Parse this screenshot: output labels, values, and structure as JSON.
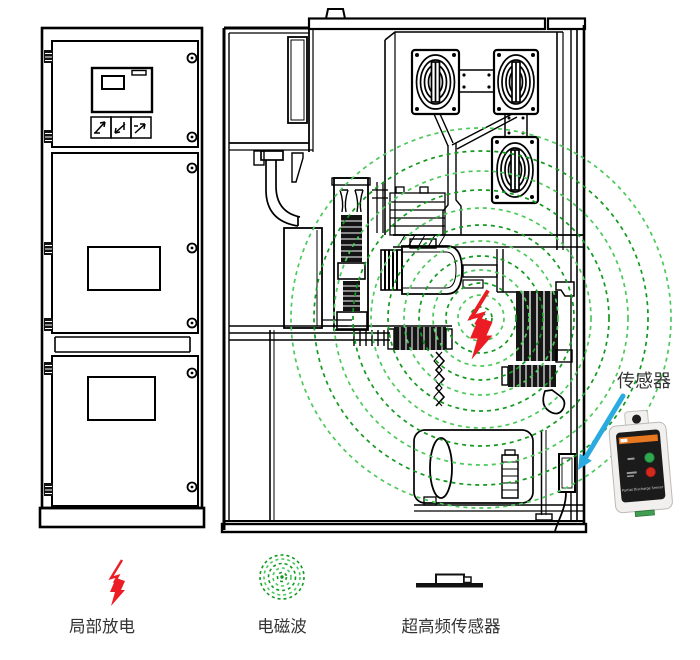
{
  "diagram": {
    "title": "switchgear-partial-discharge-uhf-detection",
    "callout": {
      "sensor_label": "传感器"
    },
    "legend": [
      {
        "id": "partial-discharge",
        "label": "局部放电",
        "symbol": "red-lightning-arrow"
      },
      {
        "id": "em-wave",
        "label": "电磁波",
        "symbol": "green-dashed-rings"
      },
      {
        "id": "uhf-sensor",
        "label": "超高频传感器",
        "symbol": "sensor-block-on-plate"
      }
    ],
    "sensor_device": {
      "panel_text": "Partial Discharge Sensor",
      "body_color": "#f1f0ee",
      "panel_color": "#1b1b1b",
      "stripe_color": "#e87820",
      "led_green": "#2fa84f",
      "led_red": "#d42a1e",
      "connector_green": "#3f9e4f"
    },
    "colors": {
      "line": "#000000",
      "em_dark": "#12991f",
      "em_light": "#4cc95a",
      "discharge_red": "#ec1c24",
      "arrow_blue": "#29aae1",
      "text": "#333333"
    }
  }
}
